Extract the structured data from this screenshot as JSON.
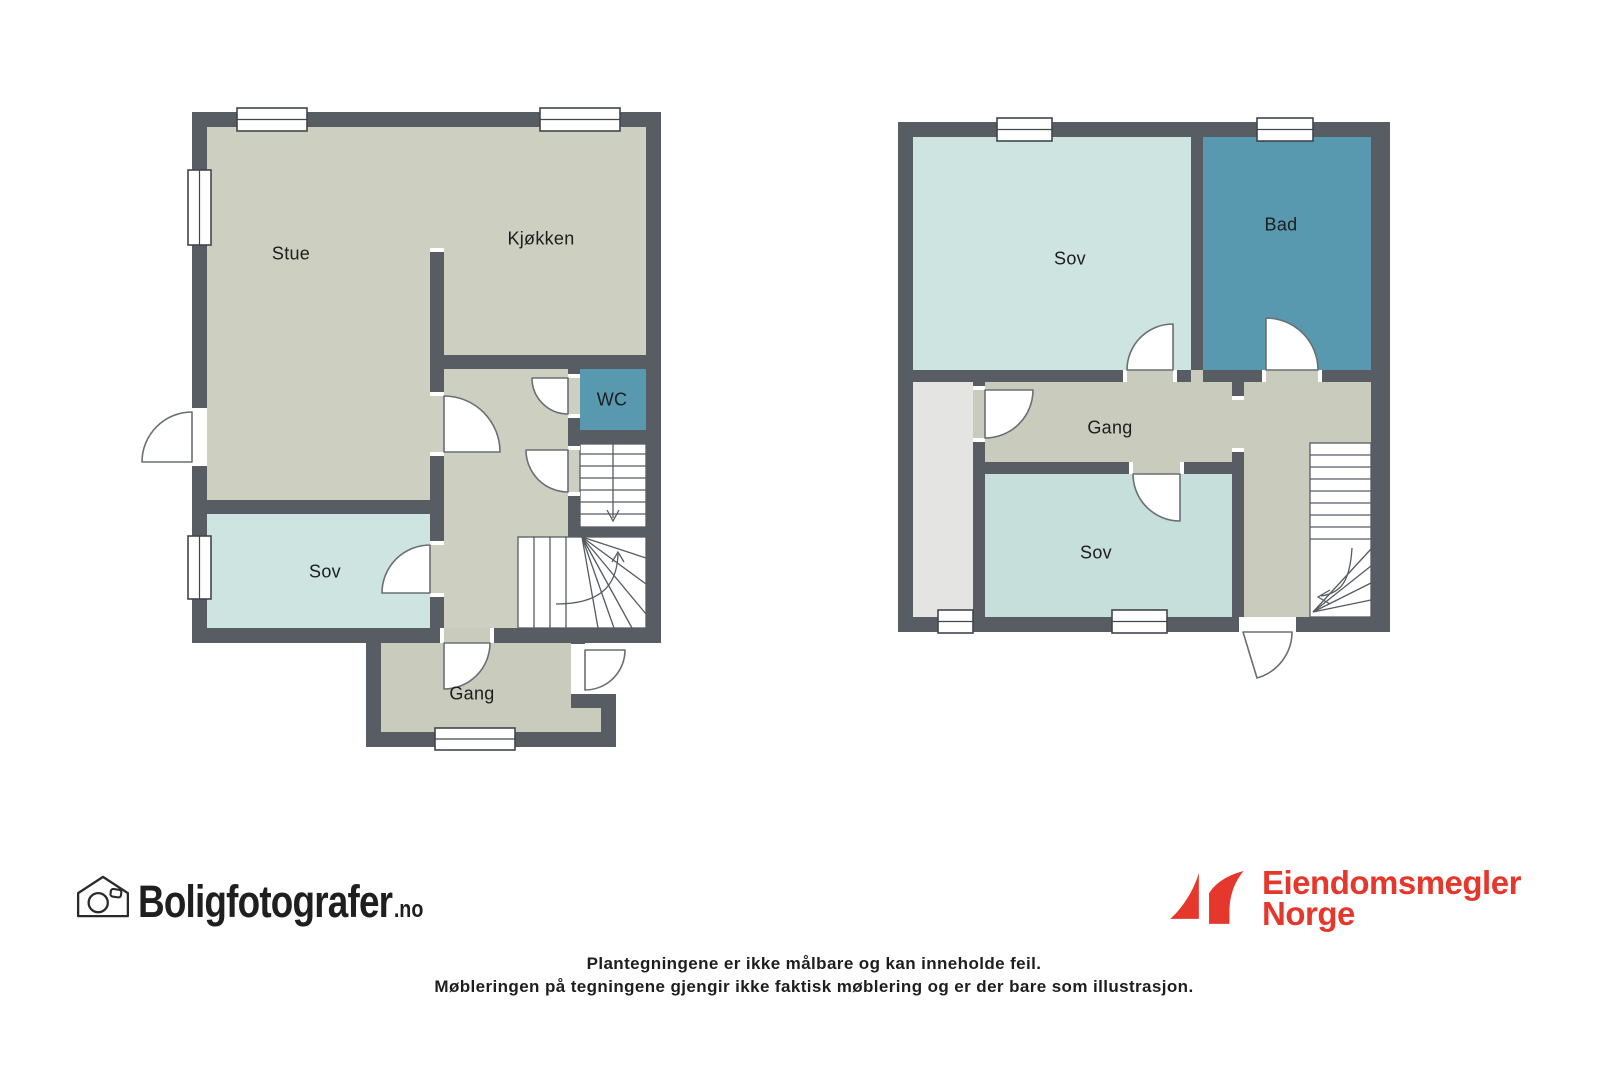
{
  "plans": {
    "first_floor": {
      "rooms": {
        "stue": "Stue",
        "kjokken": "Kjøkken",
        "wc": "WC",
        "sov": "Sov",
        "gang": "Gang"
      }
    },
    "second_floor": {
      "rooms": {
        "sov_top": "Sov",
        "bad": "Bad",
        "gang": "Gang",
        "sov_bottom": "Sov"
      }
    }
  },
  "branding": {
    "photographer": {
      "name": "Boligfotografer",
      "suffix": ".no"
    },
    "agency": {
      "line1": "Eiendomsmegler",
      "line2": "Norge",
      "brand_color": "#e6372c"
    }
  },
  "disclaimer": {
    "line1": "Plantegningene er ikke målbare og kan inneholde feil.",
    "line2": "Møbleringen på tegningene gjengir ikke faktisk møblering og er der bare som illustrasjon."
  },
  "colors": {
    "wall": "#585d64",
    "living_area": "#cdd0c1",
    "hallway": "#c9ccbd",
    "bedroom": "#cde4e0",
    "bedroom_alt": "#c7dfdb",
    "bathroom": "#5899af",
    "storage": "#e4e5e2",
    "background": "#ffffff",
    "label_text": "#1d1d1f"
  }
}
